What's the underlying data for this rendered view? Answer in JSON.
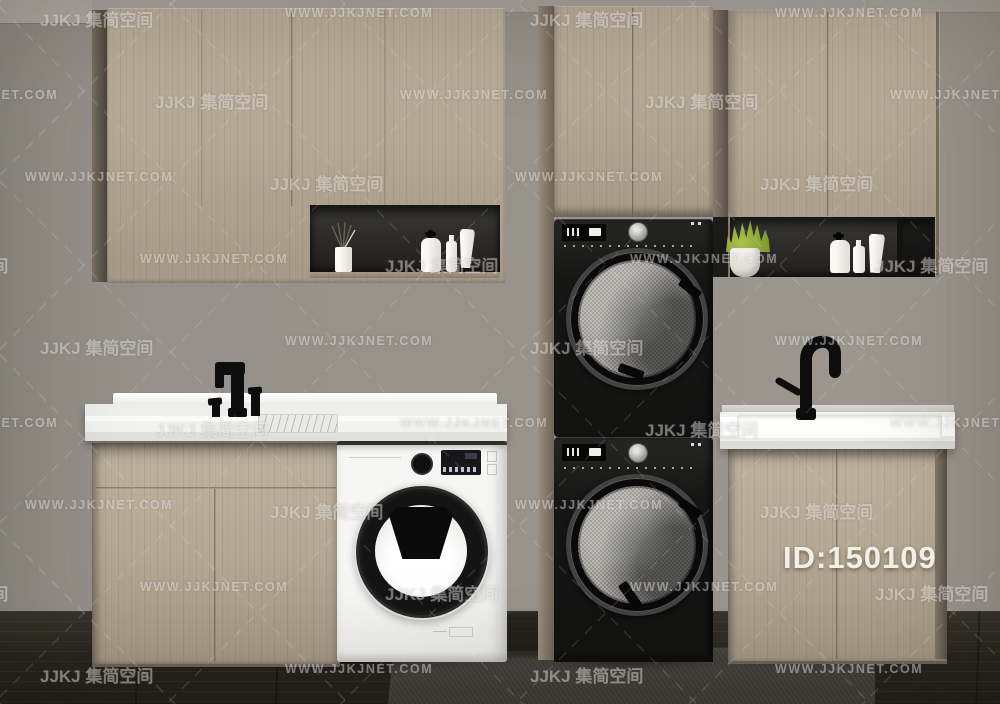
{
  "watermark": {
    "logo_text": "JJKJ 集简空间",
    "site_text": "WWW.JJKJNET.COM"
  },
  "id_badge": {
    "text": "ID:150109"
  },
  "palette": {
    "wall": "#98928b",
    "wood": "#b7aa97",
    "nicheBlack": "#221f1d",
    "machineBlack": "#121211",
    "doorMesh": "#b4b0ab",
    "washerWhite": "#eaeae7",
    "floorDark": "#29261f",
    "rugGray": "#3d3b35",
    "plantGreen": "#7f9a30",
    "fixtureBlack": "#0d0d0d",
    "watermark": "rgba(255,255,255,0.40)",
    "idText": "#f2efe7"
  }
}
